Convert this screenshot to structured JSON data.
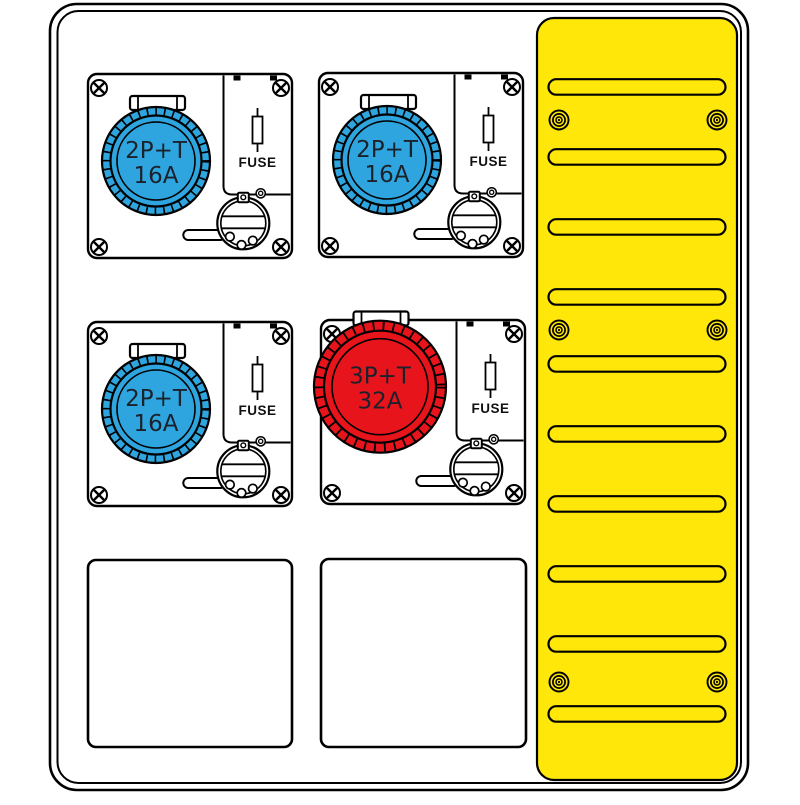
{
  "colors": {
    "socket_blue": "#2ea5de",
    "socket_red": "#e8141c",
    "panel_yellow": "#ffe70a",
    "outline": "#000000"
  },
  "modules": [
    {
      "position": "top-left",
      "socket_type": "2P+T",
      "rating": "16A",
      "fuse_label": "FUSE",
      "socket_color": "blue"
    },
    {
      "position": "top-right",
      "socket_type": "2P+T",
      "rating": "16A",
      "fuse_label": "FUSE",
      "socket_color": "blue"
    },
    {
      "position": "bottom-left",
      "socket_type": "2P+T",
      "rating": "16A",
      "fuse_label": "FUSE",
      "socket_color": "blue"
    },
    {
      "position": "bottom-right",
      "socket_type": "3P+T",
      "rating": "32A",
      "fuse_label": "FUSE",
      "socket_color": "red"
    }
  ],
  "side_panel": {
    "slot_count": 10,
    "screw_pair_count": 3
  },
  "blank_window_count": 2
}
